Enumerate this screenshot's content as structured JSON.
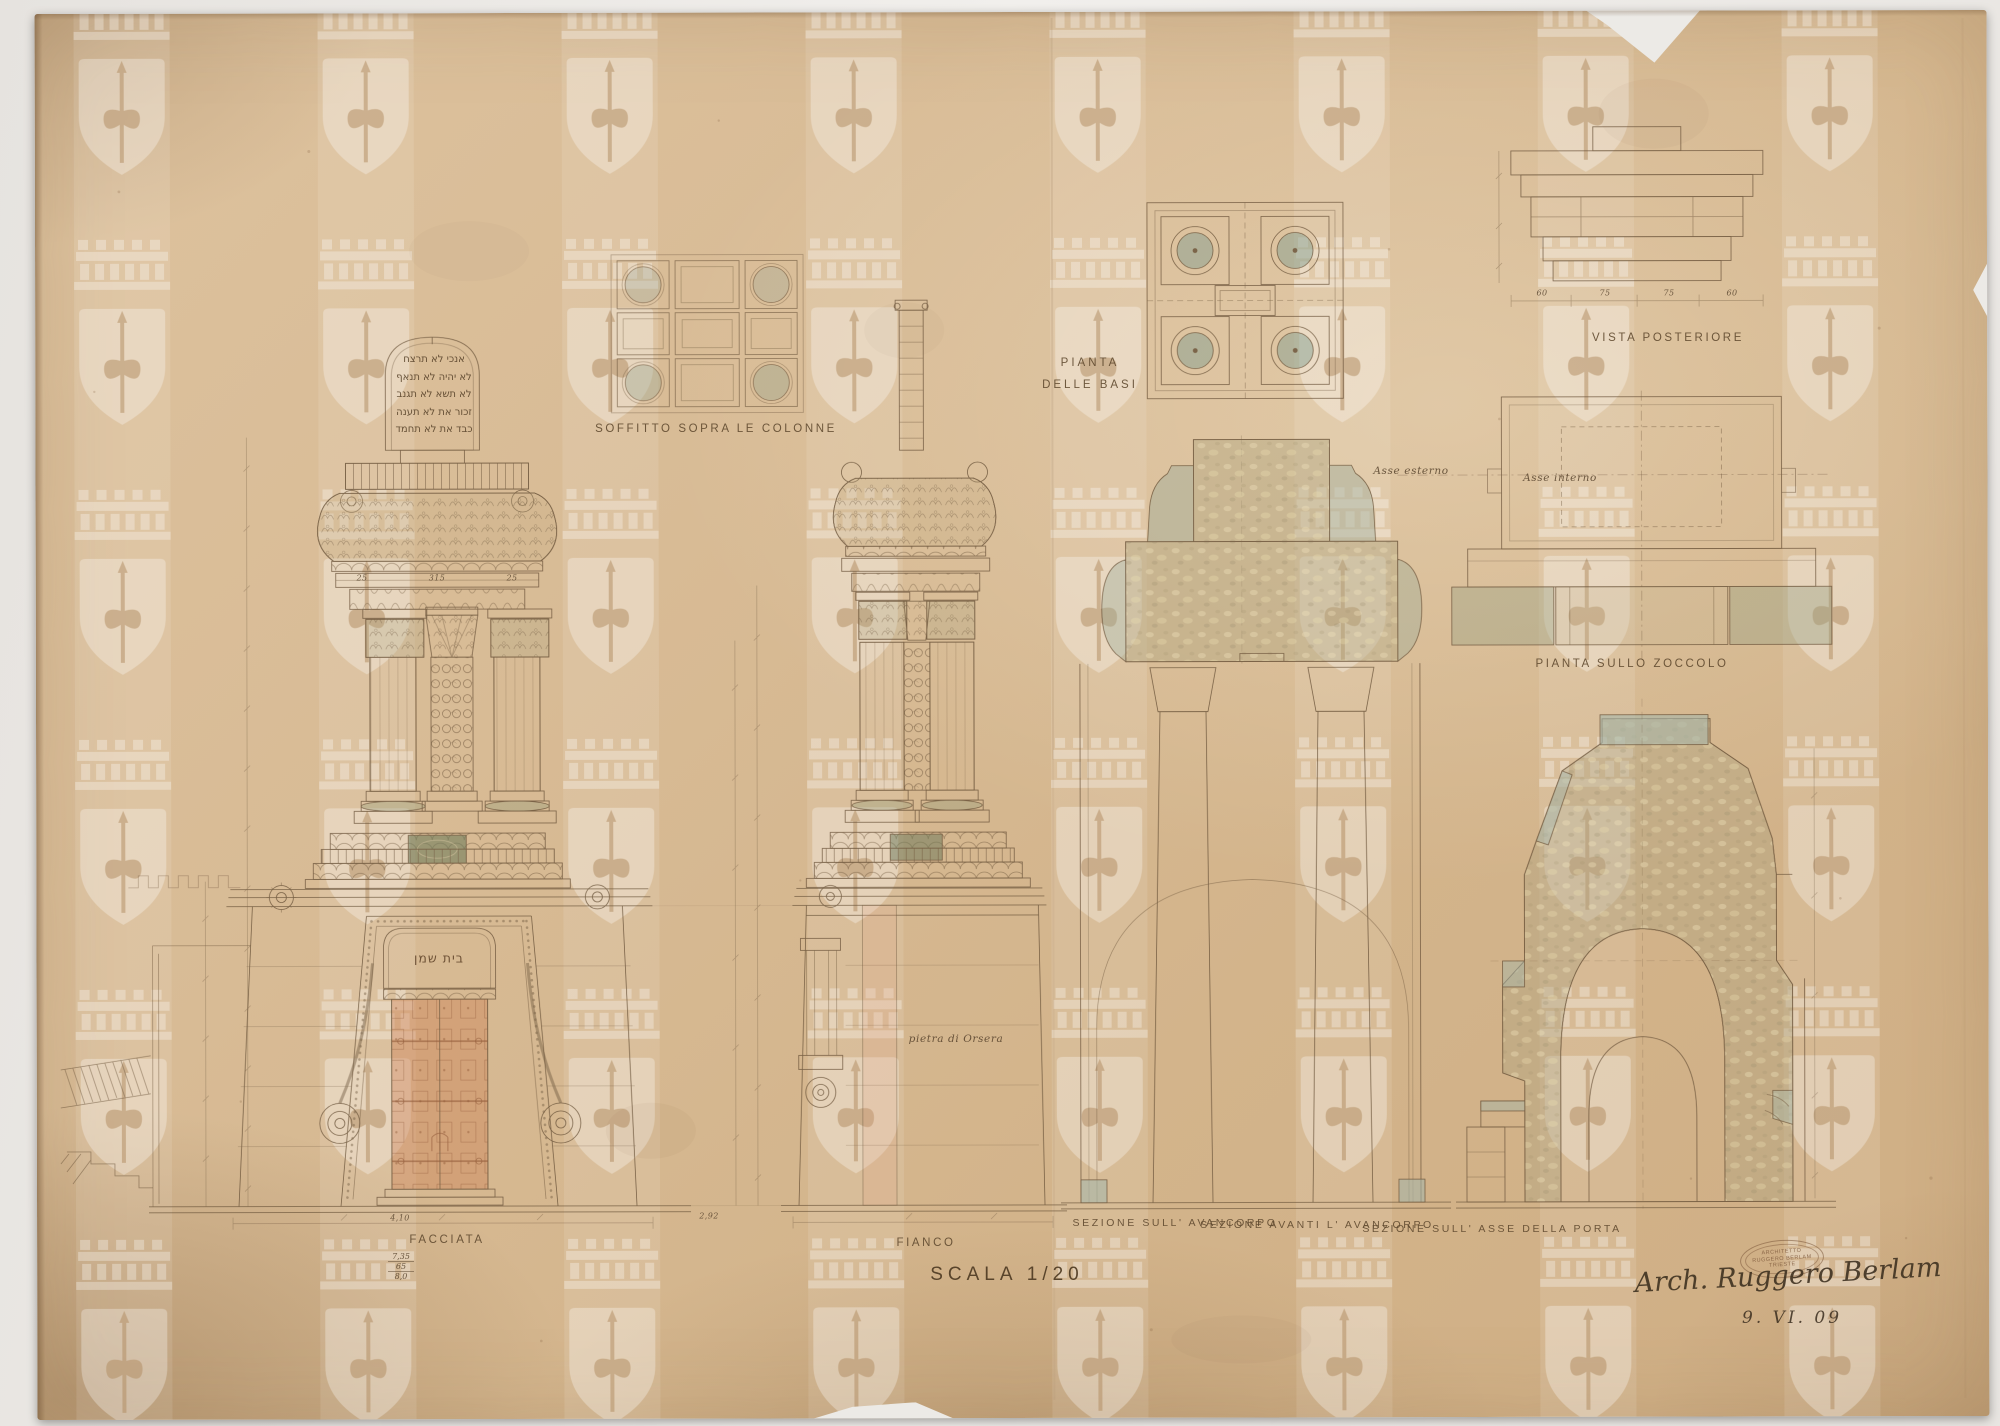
{
  "photo": {
    "backdrop_color": "#ece9e6",
    "paper_color": "#d6b992"
  },
  "title_block": {
    "scale_label": "SCALA 1/20",
    "date": "9. VI. 09",
    "signature": "Arch. Ruggero Berlam",
    "stamp_line1": "ARCHITETTO",
    "stamp_line2": "RUGGERO BERLAM",
    "stamp_line3": "TRIESTE"
  },
  "views": {
    "soffitto": {
      "label": "SOFFITTO SOPRA LE COLONNE"
    },
    "pianta_basi": {
      "label1": "PIANTA",
      "label2": "DELLE BASI"
    },
    "vista_posteriore": {
      "label": "VISTA POSTERIORE",
      "dims": [
        "60",
        "75",
        "75",
        "60"
      ]
    },
    "pianta_zoccolo": {
      "label": "PIANTA SULLO ZOCCOLO",
      "asse_esterno": "Asse esterno",
      "asse_interno": "Asse interno"
    },
    "facciata": {
      "label": "FACCIATA",
      "dims_abacus": [
        "25",
        "315",
        "25"
      ],
      "dim_width": "4,10",
      "dim_stack": [
        "7,35",
        "65",
        "8,0"
      ]
    },
    "fianco": {
      "label": "FIANCO",
      "note_material": "pietra di Orsera",
      "dim_width": "2,92"
    },
    "sezione_avancorpo": {
      "label": "SEZIONE SULL' AVANCORPO"
    },
    "sezione_avanti": {
      "label": "SEZIONE AVANTI L' AVANCORPO"
    },
    "sezione_porta": {
      "label": "SEZIONE SULL' ASSE DELLA PORTA"
    }
  },
  "hebrew": {
    "tablets": [
      "אנכי  לא תרצח",
      "לא יהיה  לא תנאף",
      "לא תשא  לא תגנב",
      "זכור את  לא תענה",
      "כבד את  לא תחמד"
    ],
    "door_plaque": "בית שמן"
  },
  "colors": {
    "ink": "#6a5339",
    "wash_olive": "#b0a57f",
    "wash_green": "#8fa08b",
    "wash_teal": "#9fb5ae",
    "door_red": "#cb7849",
    "pink_stone": "#e0a182",
    "medallion_green": "#5e7152"
  }
}
